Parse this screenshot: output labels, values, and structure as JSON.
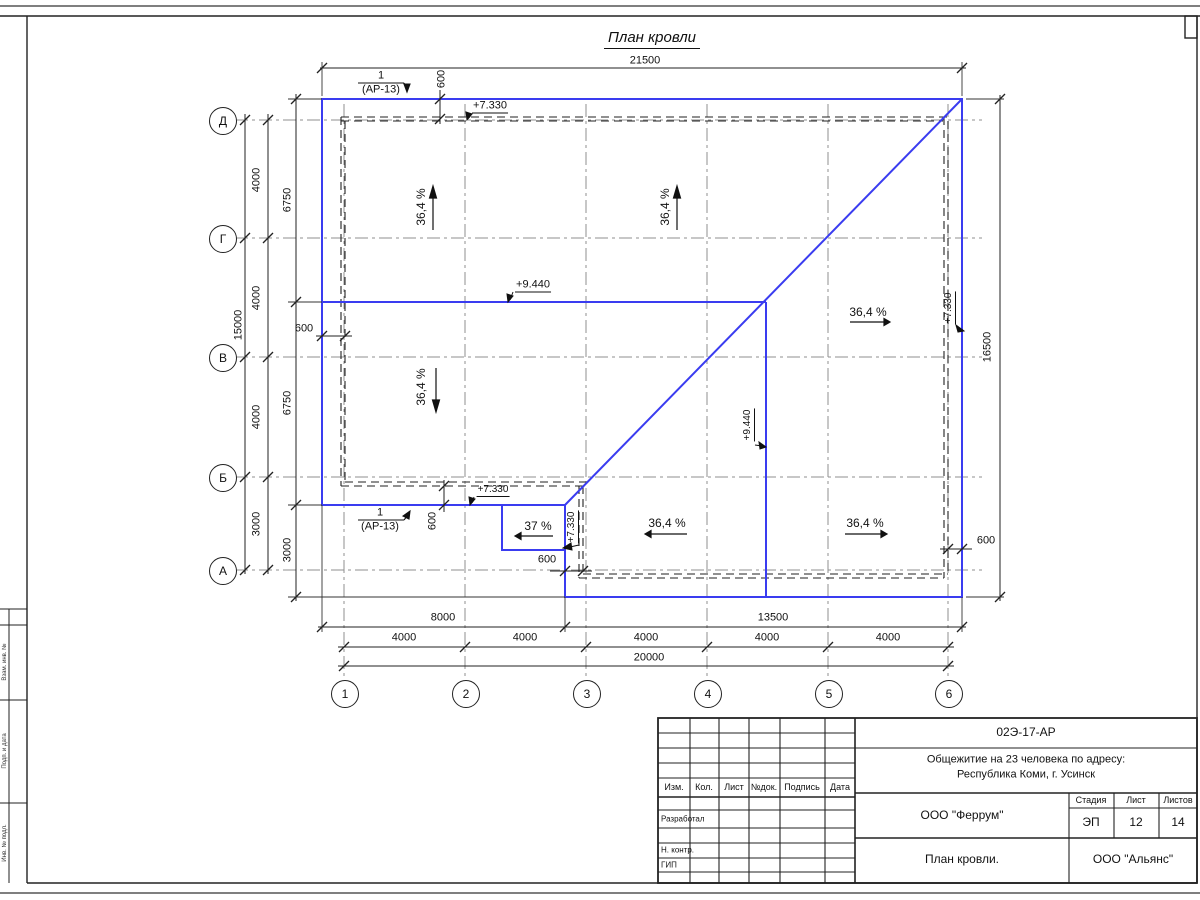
{
  "page": {
    "title": "План кровли"
  },
  "plan": {
    "accent_color": "#3a3cf0",
    "axes": {
      "rows": [
        {
          "label": "Д",
          "y": 120
        },
        {
          "label": "Г",
          "y": 238
        },
        {
          "label": "В",
          "y": 357
        },
        {
          "label": "Б",
          "y": 477
        },
        {
          "label": "А",
          "y": 570
        }
      ],
      "cols": [
        {
          "label": "1",
          "x": 344
        },
        {
          "label": "2",
          "x": 465
        },
        {
          "label": "3",
          "x": 586
        },
        {
          "label": "4",
          "x": 707
        },
        {
          "label": "5",
          "x": 828
        },
        {
          "label": "6",
          "x": 948
        }
      ]
    },
    "labels": [
      {
        "n": "dim-label",
        "t": "21500",
        "x": 645,
        "y": 61
      },
      {
        "n": "dim-label",
        "t": "600",
        "x": 442,
        "y": 79,
        "r": -90
      },
      {
        "n": "elevation-mark",
        "t": "+7.330",
        "x": 490,
        "y": 107,
        "u": 1
      },
      {
        "n": "detail-callout",
        "t": "1",
        "x": 381,
        "y": 76
      },
      {
        "n": "detail-callout",
        "t": "(АР-13)",
        "x": 381,
        "y": 90
      },
      {
        "n": "slope-label",
        "t": "36,4 %",
        "x": 421,
        "y": 207,
        "r": -90,
        "s": 12
      },
      {
        "n": "slope-label",
        "t": "36,4 %",
        "x": 665,
        "y": 207,
        "r": -90,
        "s": 12
      },
      {
        "n": "elevation-mark",
        "t": "+9.440",
        "x": 533,
        "y": 286,
        "u": 1
      },
      {
        "n": "slope-label",
        "t": "36,4 %",
        "x": 868,
        "y": 312,
        "s": 12
      },
      {
        "n": "elevation-mark",
        "t": "+7.330",
        "x": 950,
        "y": 308,
        "r": -90,
        "u": 1,
        "s": 10
      },
      {
        "n": "dim-label",
        "t": "16500",
        "x": 988,
        "y": 347,
        "r": -90
      },
      {
        "n": "dim-label",
        "t": "600",
        "x": 304,
        "y": 329
      },
      {
        "n": "slope-label",
        "t": "36,4 %",
        "x": 421,
        "y": 387,
        "r": -90,
        "s": 12
      },
      {
        "n": "elevation-mark",
        "t": "+9.440",
        "x": 749,
        "y": 425,
        "r": -90,
        "u": 1,
        "s": 10
      },
      {
        "n": "dim-label",
        "t": "6750",
        "x": 288,
        "y": 200,
        "r": -90
      },
      {
        "n": "dim-label",
        "t": "6750",
        "x": 288,
        "y": 403,
        "r": -90
      },
      {
        "n": "dim-label",
        "t": "3000",
        "x": 288,
        "y": 550,
        "r": -90
      },
      {
        "n": "dim-label",
        "t": "15000",
        "x": 239,
        "y": 325,
        "r": -90
      },
      {
        "n": "dim-label",
        "t": "4000",
        "x": 257,
        "y": 180,
        "r": -90
      },
      {
        "n": "dim-label",
        "t": "4000",
        "x": 257,
        "y": 298,
        "r": -90
      },
      {
        "n": "dim-label",
        "t": "4000",
        "x": 257,
        "y": 417,
        "r": -90
      },
      {
        "n": "dim-label",
        "t": "3000",
        "x": 257,
        "y": 524,
        "r": -90
      },
      {
        "n": "detail-callout",
        "t": "1",
        "x": 380,
        "y": 513
      },
      {
        "n": "detail-callout",
        "t": "(АР-13)",
        "x": 380,
        "y": 527
      },
      {
        "n": "dim-label",
        "t": "600",
        "x": 433,
        "y": 521,
        "r": -90
      },
      {
        "n": "elevation-mark",
        "t": "+7.330",
        "x": 493,
        "y": 491,
        "u": 1,
        "s": 10
      },
      {
        "n": "slope-label",
        "t": "37 %",
        "x": 538,
        "y": 526,
        "s": 12
      },
      {
        "n": "elevation-mark",
        "t": "+7.330",
        "x": 573,
        "y": 527,
        "r": -90,
        "u": 1,
        "s": 10
      },
      {
        "n": "dim-label",
        "t": "600",
        "x": 547,
        "y": 560
      },
      {
        "n": "slope-label",
        "t": "36,4 %",
        "x": 667,
        "y": 523,
        "s": 12
      },
      {
        "n": "slope-label",
        "t": "36,4 %",
        "x": 865,
        "y": 523,
        "s": 12
      },
      {
        "n": "dim-label",
        "t": "600",
        "x": 986,
        "y": 541
      },
      {
        "n": "dim-label",
        "t": "8000",
        "x": 443,
        "y": 618
      },
      {
        "n": "dim-label",
        "t": "13500",
        "x": 773,
        "y": 618
      },
      {
        "n": "dim-label",
        "t": "4000",
        "x": 404,
        "y": 638
      },
      {
        "n": "dim-label",
        "t": "4000",
        "x": 525,
        "y": 638
      },
      {
        "n": "dim-label",
        "t": "4000",
        "x": 646,
        "y": 638
      },
      {
        "n": "dim-label",
        "t": "4000",
        "x": 767,
        "y": 638
      },
      {
        "n": "dim-label",
        "t": "4000",
        "x": 888,
        "y": 638
      },
      {
        "n": "dim-label",
        "t": "20000",
        "x": 649,
        "y": 658
      }
    ]
  },
  "sidebar": {
    "items": [
      {
        "label": "Взам. инв. №",
        "y1": 625,
        "y2": 700
      },
      {
        "label": "Подп. и дата",
        "y1": 700,
        "y2": 803
      },
      {
        "label": "Инв. № подл.",
        "y1": 803,
        "y2": 883
      }
    ]
  },
  "title_block": {
    "doc_number": "02Э-17-АР",
    "project_line1": "Общежитие на 23 человека по адресу:",
    "project_line2": "Республика Коми, г. Усинск",
    "columns": [
      "Изм.",
      "Кол.",
      "Лист",
      "№док.",
      "Подпись",
      "Дата"
    ],
    "row_labels": [
      "Разработал",
      "Н. контр.",
      "ГИП"
    ],
    "designer": "ООО \"Феррум\"",
    "stage_label": "Стадия",
    "sheet_label": "Лист",
    "sheets_label": "Листов",
    "stage": "ЭП",
    "sheet": "12",
    "sheets": "14",
    "drawing_name": "План кровли.",
    "company": "ООО \"Альянс\""
  }
}
